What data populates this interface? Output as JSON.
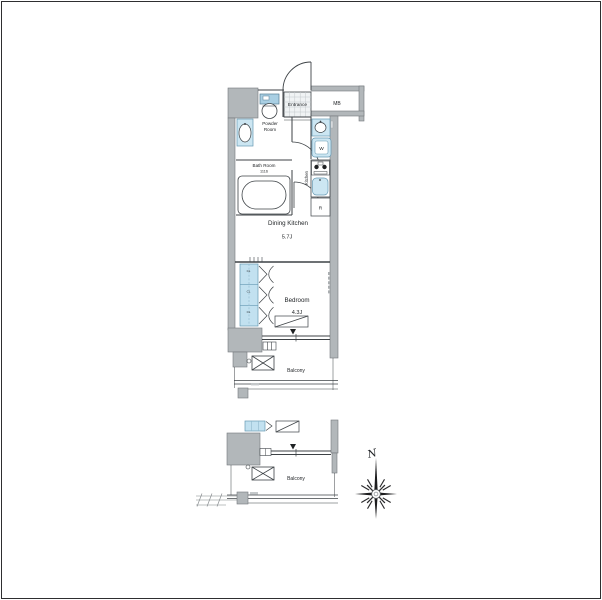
{
  "plan": {
    "labels": {
      "entrance": "Entrance",
      "meter_box": "MB",
      "powder_room": [
        "Powder",
        "Room"
      ],
      "bath_room": "Bath Room",
      "bath_size": "1116",
      "washer": "W",
      "kitchen": "Kitchen",
      "refrigerator": "R",
      "dining_kitchen": "Dining Kitchen",
      "dining_kitchen_size": "5.7J",
      "bedroom": "Bedroom",
      "bedroom_size": "4.3J",
      "closet": "CL",
      "balcony_upper": "Balcony",
      "balcony_lower": "Balcony",
      "compass_north": "N"
    },
    "colors": {
      "wall_gray": "#b2b7ba",
      "fixture_blue": "#cce6f2",
      "closet_blue": "#c2e1f0",
      "line": "#3d4246",
      "tile": "#f0f3f4"
    }
  }
}
